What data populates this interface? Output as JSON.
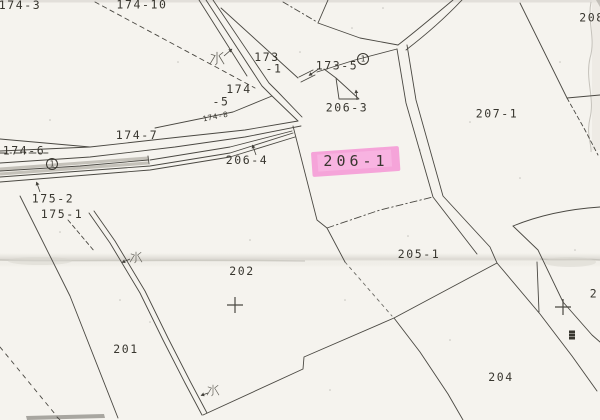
{
  "map": {
    "type": "scanned-cadastral-map",
    "paper_color": "#f5f3ee",
    "ink_color": "#38362f",
    "highlight_color": "#f590d3",
    "highlight_inner_color": "#f9c0e7",
    "parcel_labels": [
      {
        "text": "174-3",
        "x": 20,
        "y": 9,
        "cut": "top"
      },
      {
        "text": "174-10",
        "x": 142,
        "y": 8.5,
        "cut": "top"
      },
      {
        "text": "173",
        "x": 267,
        "y": 61
      },
      {
        "text": "-1",
        "x": 274,
        "y": 72.5
      },
      {
        "text": "174",
        "x": 239,
        "y": 93
      },
      {
        "text": "-5",
        "x": 221,
        "y": 105.5
      },
      {
        "text": "174-8",
        "x": 216,
        "y": 119,
        "size": 7.5,
        "spacing": 0.7,
        "rot": -11
      },
      {
        "text": "174-7",
        "x": 137,
        "y": 139
      },
      {
        "text": "174-6",
        "x": 24,
        "y": 154.5
      },
      {
        "text": "173-5",
        "x": 337,
        "y": 69.5
      },
      {
        "text": "206-3",
        "x": 347,
        "y": 111.5
      },
      {
        "text": "206-4",
        "x": 247,
        "y": 164
      },
      {
        "text": "206-1",
        "x": 356,
        "y": 166,
        "size": 15,
        "spacing": 4,
        "highlight": true
      },
      {
        "text": "207-1",
        "x": 497,
        "y": 117.5
      },
      {
        "text": "208",
        "x": 592,
        "y": 21.5,
        "cut": "right"
      },
      {
        "text": "175-2",
        "x": 53,
        "y": 202.5
      },
      {
        "text": "175-1",
        "x": 62,
        "y": 218
      },
      {
        "text": "205-1",
        "x": 419,
        "y": 258
      },
      {
        "text": "202",
        "x": 242,
        "y": 275
      },
      {
        "text": "201",
        "x": 126,
        "y": 353
      },
      {
        "text": "204",
        "x": 501,
        "y": 381
      },
      {
        "text": "2",
        "x": 594,
        "y": 297.5,
        "cut": "right"
      }
    ],
    "water_marks": [
      {
        "text": "水",
        "x": 217,
        "y": 58,
        "scale": 0.95
      },
      {
        "text": "水",
        "x": 136,
        "y": 257,
        "scale": 0.8
      },
      {
        "text": "水",
        "x": 213,
        "y": 390,
        "scale": 0.8
      }
    ],
    "road_mark": {
      "text": "道",
      "x": 572,
      "y": 335
    },
    "circled_marks": [
      {
        "text": "1",
        "x": 52,
        "y": 164
      },
      {
        "text": "1",
        "x": 363,
        "y": 59
      }
    ],
    "survey_crosses": [
      {
        "x": 235,
        "y": 305
      },
      {
        "x": 563,
        "y": 307
      }
    ]
  }
}
